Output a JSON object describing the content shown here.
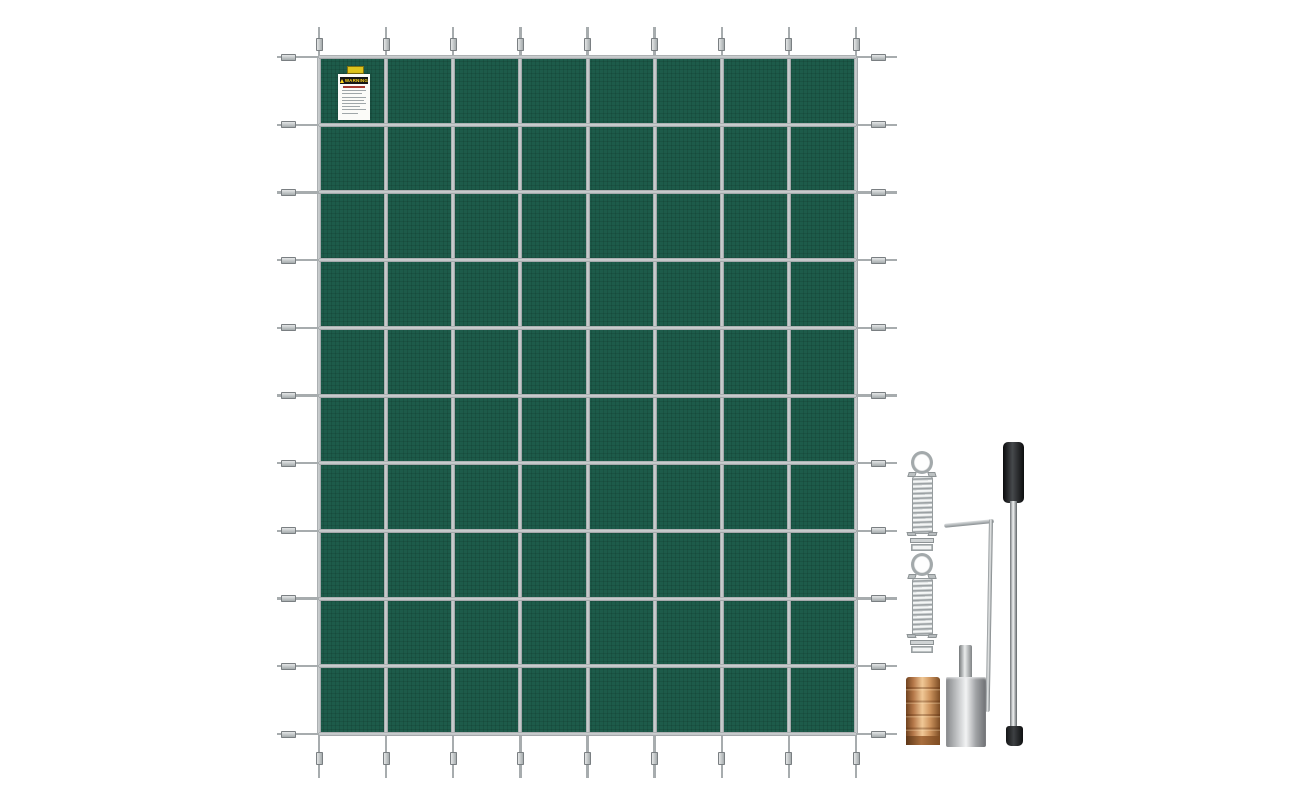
{
  "scene": {
    "type": "product-photo",
    "background_color": "#ffffff",
    "subject": "Green rectangular inground pool safety cover with silver strap grid and installation hardware kit"
  },
  "cover": {
    "mesh_color": "#1d5b4a",
    "strap_color": "#b7bcbd",
    "vertical_strap_count": 9,
    "horizontal_strap_count": 11,
    "warning_label": {
      "tab_color": "#ddc31d",
      "banner_text": "WARNING",
      "banner_bg": "#161616",
      "banner_text_color": "#ffd51c"
    }
  },
  "hardware": {
    "springs": {
      "count": 2,
      "item": "stainless tension spring with ring and base clip",
      "color": "#b0b5b7"
    },
    "hex_key": {
      "item": "L-shaped hex key",
      "color": "#aeb3b5"
    },
    "installation_rod": {
      "item": "anchor installation rod",
      "handle_color": "#1b1c1e",
      "shaft_color": "#c6c9ca",
      "tip_color": "#141516"
    },
    "brass_anchor": {
      "item": "brass screw anchor",
      "color": "#c98f5a"
    },
    "steel_tool": {
      "item": "steel tamping tool with stem",
      "color": "#c0c2c4"
    }
  }
}
